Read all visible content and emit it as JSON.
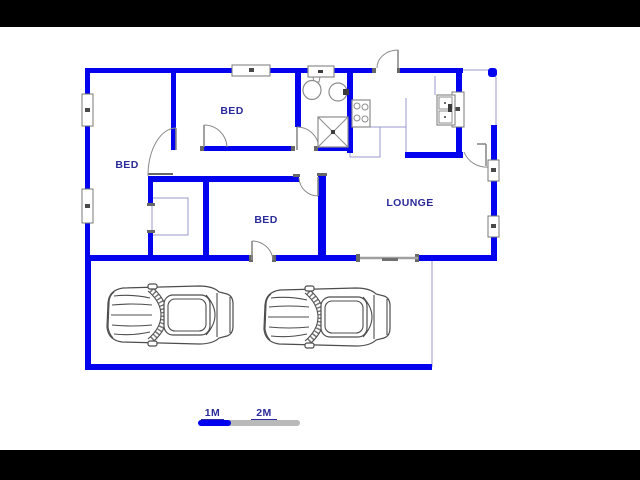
{
  "plan": {
    "rooms": [
      {
        "name": "bedroom-1",
        "label": "BED"
      },
      {
        "name": "bedroom-2",
        "label": "BED"
      },
      {
        "name": "bedroom-3",
        "label": "BED"
      },
      {
        "name": "lounge",
        "label": "LOUNGE"
      }
    ],
    "fixtures": [
      "toilet",
      "wash-basin",
      "shower",
      "stove",
      "kitchen-sink",
      "built-in-cupboard",
      "car",
      "car"
    ],
    "windows": 6,
    "doors": 7
  },
  "scale_bar": {
    "labels": [
      "1M",
      "2M"
    ]
  },
  "colors": {
    "wall": "#0202ee",
    "label": "#2b2b9b",
    "thin": "#9a9ace",
    "fixture": "#8c8c8c",
    "door": "#8a8a8a",
    "jamb": "#686868",
    "bargray": "#b9b9b9",
    "letterbox": "#000000"
  }
}
